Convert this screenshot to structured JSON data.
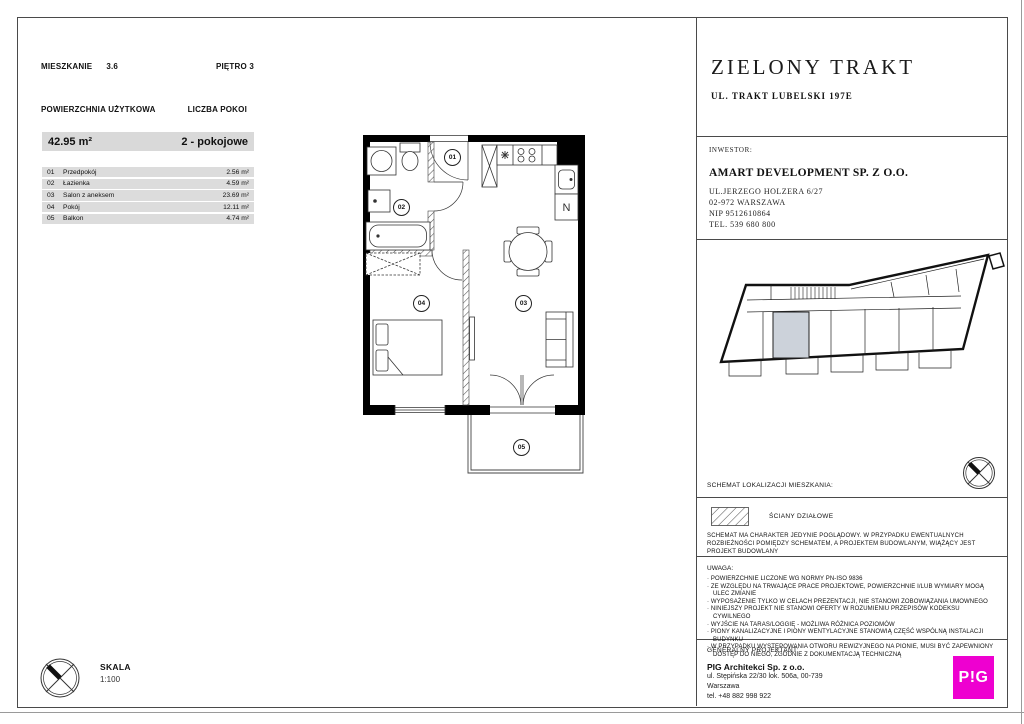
{
  "header": {
    "apartment_label": "MIESZKANIE",
    "apartment_number": "3.6",
    "floor": "PIĘTRO 3",
    "area_label": "POWIERZCHNIA UŻYTKOWA",
    "rooms_label": "LICZBA POKOI",
    "total_area": "42.95 m²",
    "rooms_count": "2 - pokojowe"
  },
  "rooms": [
    {
      "num": "01",
      "name": "Przedpokój",
      "area": "2.56 m²"
    },
    {
      "num": "02",
      "name": "Łazienka",
      "area": "4.59 m²"
    },
    {
      "num": "03",
      "name": "Salon z aneksem",
      "area": "23.69 m²"
    },
    {
      "num": "04",
      "name": "Pokój",
      "area": "12.11 m²"
    },
    {
      "num": "05",
      "name": "Balkon",
      "area": "4.74 m²"
    }
  ],
  "plan": {
    "labels": [
      "01",
      "02",
      "03",
      "04",
      "05"
    ],
    "fridge_label": "N"
  },
  "scale": {
    "label": "SKALA",
    "value": "1:100"
  },
  "sidebar": {
    "project_name": "ZIELONY TRAKT",
    "project_address": "UL. TRAKT LUBELSKI 197E",
    "investor_label": "INWESTOR:",
    "investor_name": "AMART DEVELOPMENT SP. Z O.O.",
    "investor_address1": "UL.JERZEGO HOLZERA 6/27",
    "investor_address2": "02-972 WARSZAWA",
    "investor_nip": "NIP 9512610864",
    "investor_tel": "TEL. 539 680 800",
    "locator_label": "SCHEMAT LOKALIZACJI MIESZKANIA:",
    "legend_walls": "ŚCIANY DZIAŁOWE",
    "disclaimer": "SCHEMAT MA CHARAKTER JEDYNIE POGLĄDOWY. W PRZYPADKU EWENTUALNYCH ROZBIEŻNOŚCI POMIĘDZY SCHEMATEM, A PROJEKTEM BUDOWLANYM, WIĄŻĄCY JEST PROJEKT BUDOWLANY",
    "uwaga_title": "UWAGA:",
    "uwaga_items": [
      "· POWIERZCHNIE LICZONE WG NORMY PN-ISO 9836",
      "· ZE WZGLĘDU NA TRWAJĄCE PRACE PROJEKTOWE, POWIERZCHNIE I/LUB WYMIARY MOGĄ ULEC ZMIANIE",
      "· WYPOSAŻENIE TYLKO W CELACH PREZENTACJI, NIE STANOWI ZOBOWIĄZANIA UMOWNEGO",
      "· NINIEJSZY PROJEKT NIE STANOWI OFERTY W ROZUMIENIU PRZEPISÓW KODEKSU CYWILNEGO",
      "· WYJŚCIE NA TARAS/LOGGIĘ - MOŻLIWA RÓŻNICA POZIOMÓW",
      "· PIONY KANALIZACYJNE I PIONY WENTYLACYJNE  STANOWIĄ CZĘŚĆ WSPÓLNĄ INSTALACJI BUDYNKU",
      "· W PRZYPADKU WYSTĘPOWANIA OTWORU REWIZYJNEGO NA PIONIE, MUSI BYĆ ZAPEWNIONY DOSTĘP DO NIEGO, ZGODNIE Z DOKUMENTACJĄ TECHNICZNĄ"
    ],
    "designer_label": "GENERALNY PROJEKTANT:",
    "designer_name": "PIG Architekci Sp. z o.o.",
    "designer_address1": "ul. Stępińska 22/30 lok. 506a, 00-739",
    "designer_address2": "Warszawa",
    "designer_tel": "tel. +48 882 998 922",
    "logo_text": "P!G"
  },
  "colors": {
    "accent_magenta": "#ee00d0",
    "highlight_unit": "#ccd2da",
    "table_row_gray": "#dcdcdc"
  }
}
